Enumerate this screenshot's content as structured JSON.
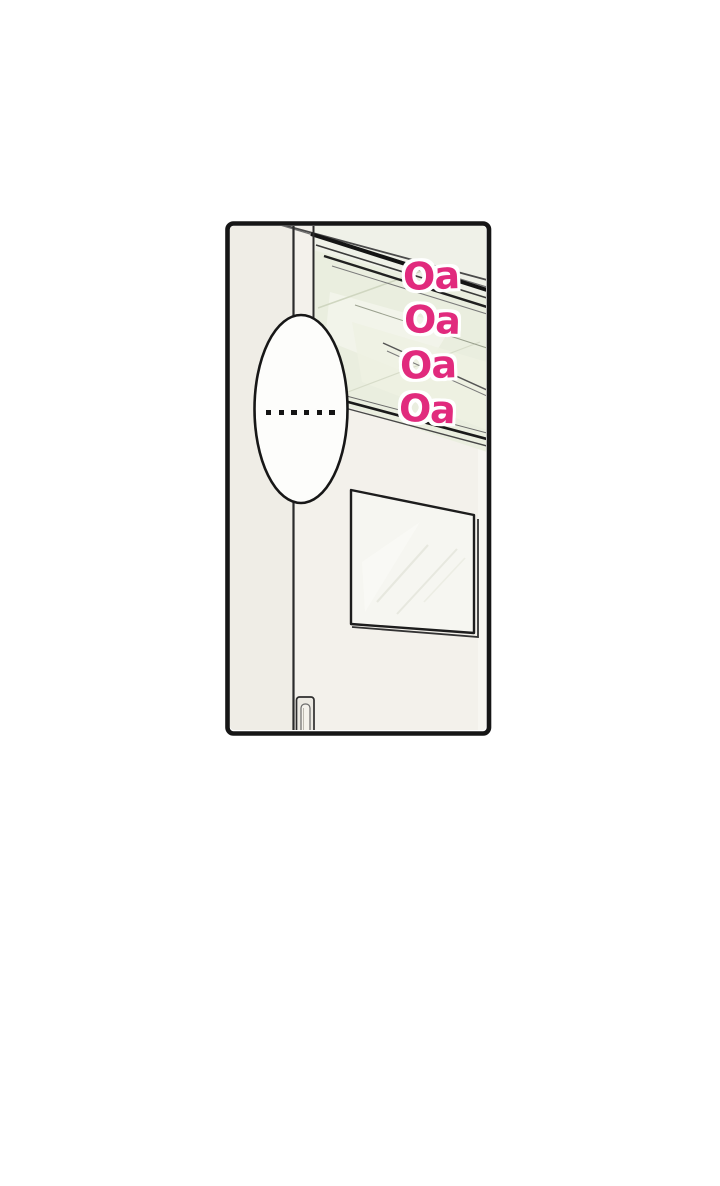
{
  "page": {
    "background_color": "#ffffff"
  },
  "panel": {
    "border_color": "#161616",
    "door_face_color": "#f3f1eb",
    "glass_tint_color": "#eaeedf",
    "speech_bubble": {
      "text": "......"
    },
    "sfx": {
      "color": "#e12a7d",
      "outline_color": "#ffffff",
      "items": [
        {
          "text": "Oa"
        },
        {
          "text": "Oa"
        },
        {
          "text": "Oa"
        },
        {
          "text": "Oa"
        }
      ]
    }
  }
}
